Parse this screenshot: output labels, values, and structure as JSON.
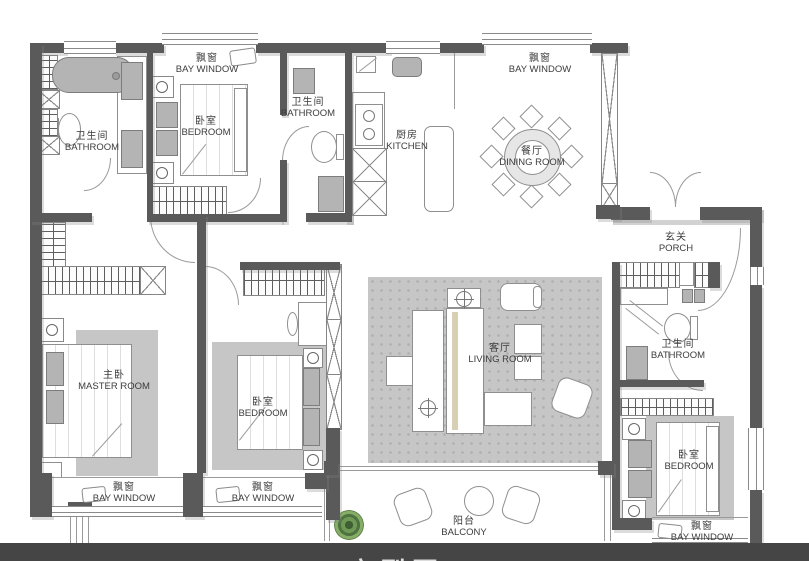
{
  "plan": {
    "labels": {
      "bay_window": {
        "zh": "飘窗",
        "en": "BAY WINDOW"
      },
      "bathroom": {
        "zh": "卫生间",
        "en": "BATHROOM"
      },
      "bedroom": {
        "zh": "卧室",
        "en": "BEDROOM"
      },
      "kitchen": {
        "zh": "厨房",
        "en": "KITCHEN"
      },
      "dining_room": {
        "zh": "餐厅",
        "en": "DINING ROOM"
      },
      "porch": {
        "zh": "玄关",
        "en": "PORCH"
      },
      "master_room": {
        "zh": "主卧",
        "en": "MASTER ROOM"
      },
      "living_room": {
        "zh": "客厅",
        "en": "LIVING ROOM"
      },
      "balcony": {
        "zh": "阳台",
        "en": "BALCONY"
      }
    },
    "footer_title": "户型图",
    "colors": {
      "wall": "#5a5a5a",
      "furniture_gray": "#b4b4b4",
      "rug_gray": "#c6c6c6",
      "footer_band": "#454545",
      "plant_green": "#6f9a55",
      "label_text": "#3c3c3c"
    }
  }
}
